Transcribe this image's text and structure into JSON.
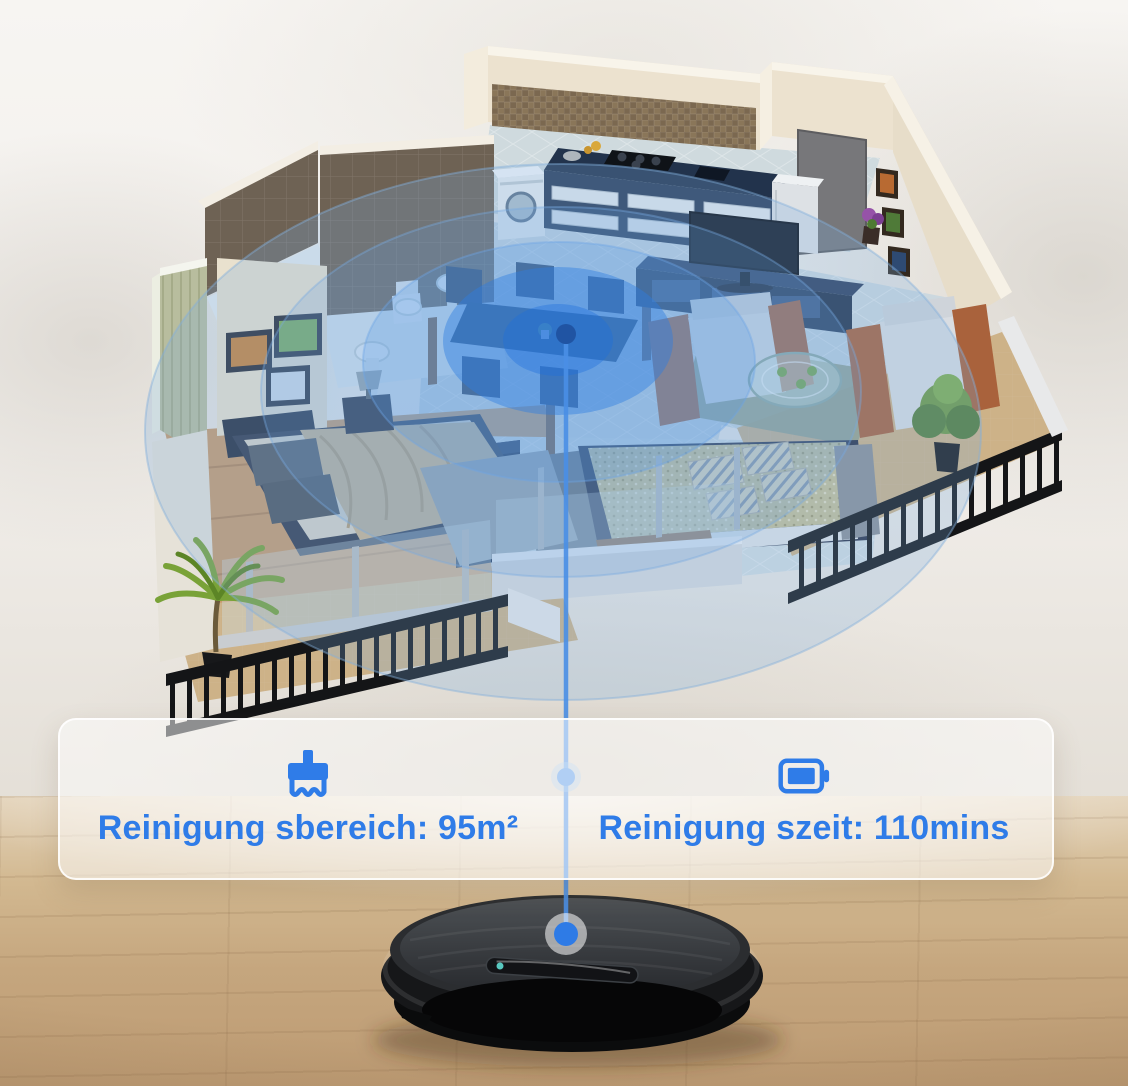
{
  "banner": {
    "stats": [
      {
        "icon": "brush-icon",
        "text": "Reinigung sbereich: 95m²"
      },
      {
        "icon": "battery-icon",
        "text": "Reinigung szeit: 110mins"
      }
    ]
  },
  "colors": {
    "accent_blue": "#2f7ce8",
    "radar_blue": "#3f86dd",
    "signal_line_blue": "#4a8fe6",
    "wall_cream": "#ece2cf",
    "wood_floor": "#c5a67e"
  },
  "icons": [
    "brush-icon",
    "battery-icon"
  ],
  "scene_markers": {
    "signal_origin": "dining-room-center",
    "signal_target": "robot-vacuum-top"
  }
}
